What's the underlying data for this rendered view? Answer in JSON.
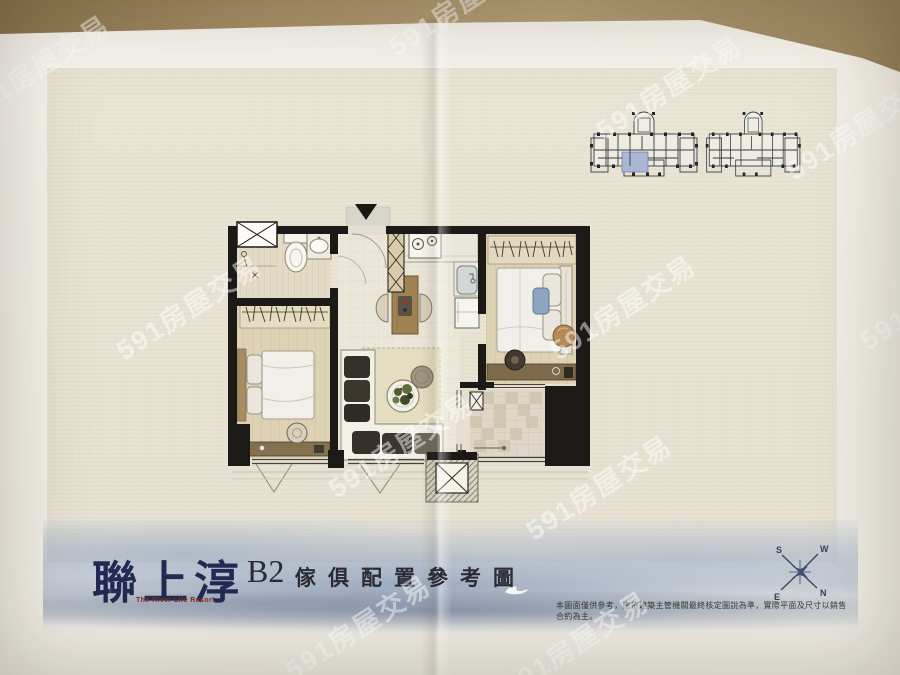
{
  "photo": {
    "watermark_text": "591房屋交易"
  },
  "brand": {
    "logo": "聯上淳",
    "subtitle": "The River Life Resort"
  },
  "plan": {
    "code": "B2",
    "title": "傢俱配置參考圖",
    "disclaimer": "本圖面僅供參考，應依建築主管機關最終核定圖說為準，實際平面及尺寸以銷售合約為主。"
  },
  "compass": {
    "n": "N",
    "s": "S",
    "e": "E",
    "w": "W"
  },
  "colors": {
    "logo_navy": "#202b54",
    "subtitle_red": "#8c2a1c",
    "highlight_unit_blue": "#a9b6d4",
    "watercolor_blue": "#8fa2bc",
    "wall_black": "#1c1a17"
  }
}
